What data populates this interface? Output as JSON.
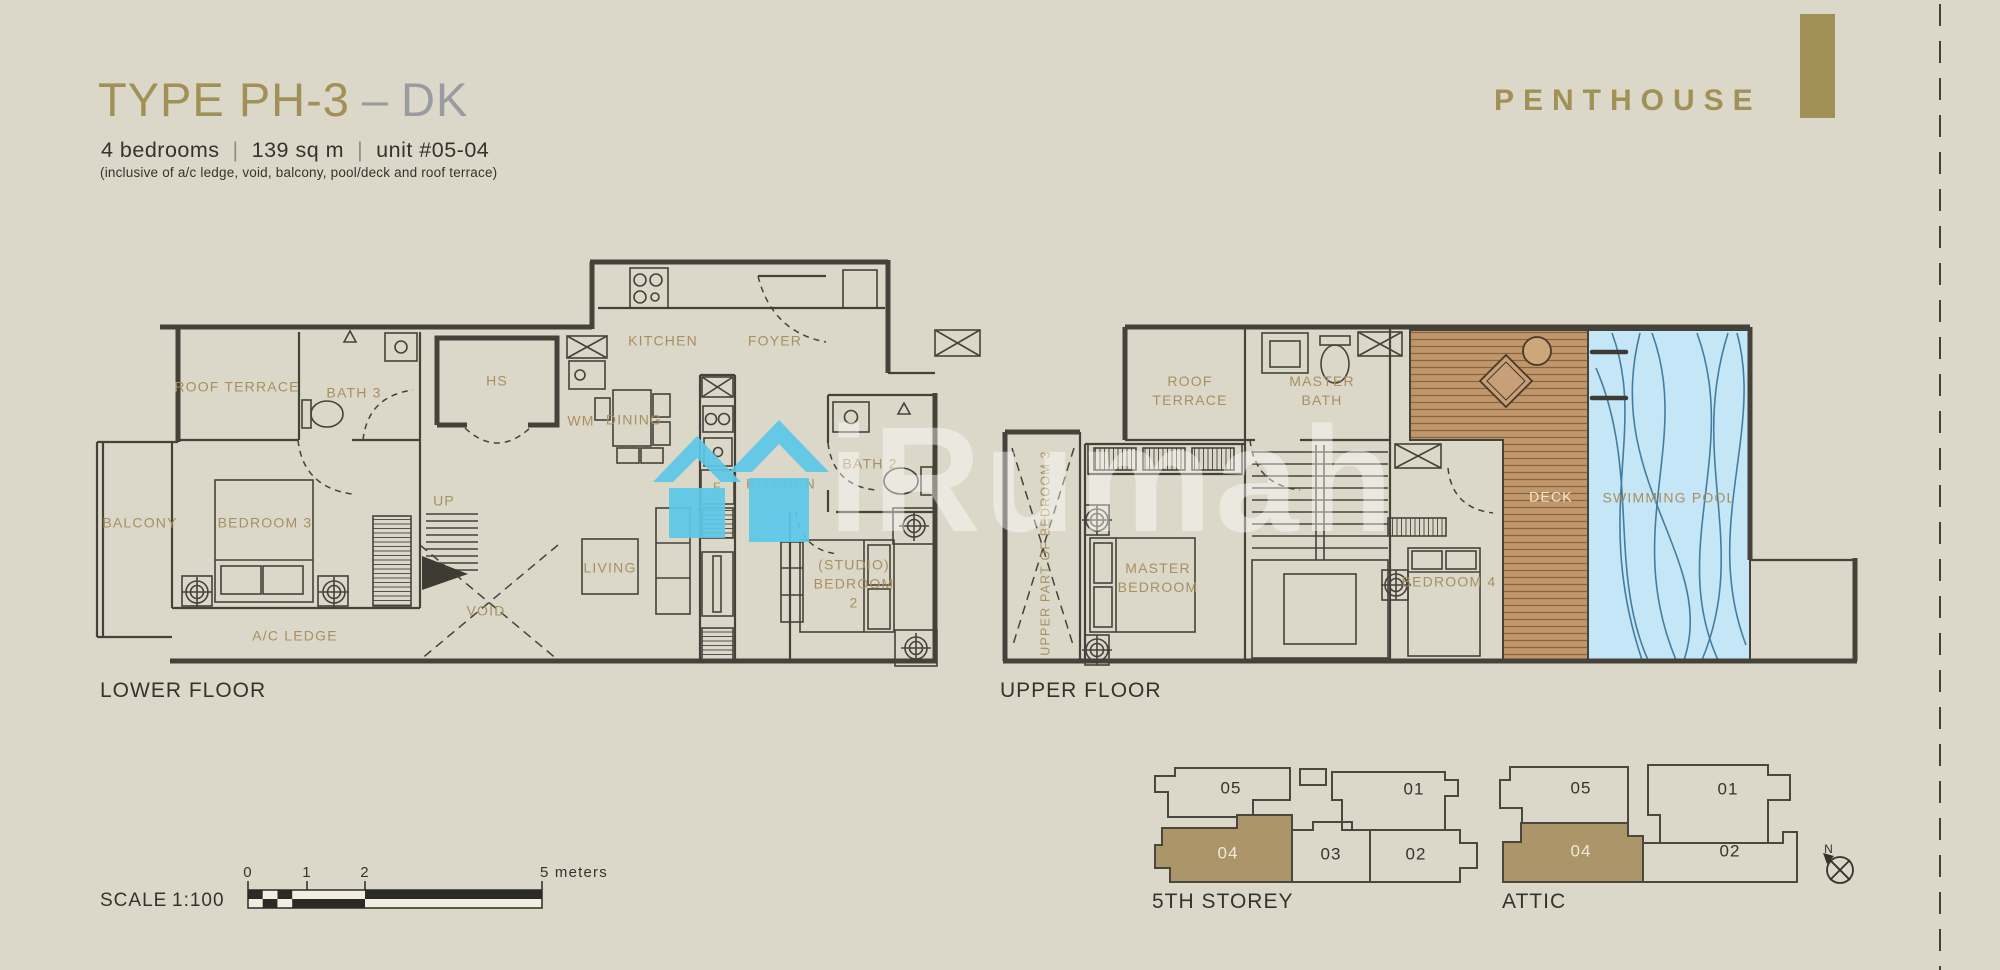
{
  "colors": {
    "background": "#dbd7c9",
    "accent_gold": "#a29156",
    "room_label_tan": "#a8905f",
    "wall_ink": "#45423a",
    "pool_blue_fill": "#c5e6f7",
    "pool_line_blue": "#2e6a92",
    "deck_brown": "#c0966a",
    "watermark_teal": "#5cc8e9",
    "highlight_unit_gold": "#ab9569"
  },
  "header": {
    "title_main": "TYPE PH-3",
    "title_sep": "–",
    "title_suffix": "DK",
    "bedrooms": "4 bedrooms",
    "area": "139 sq m",
    "unit": "unit #05-04",
    "separator": "|",
    "note": "(inclusive of a/c ledge, void, balcony, pool/deck and roof terrace)",
    "brand": "PENTHOUSE"
  },
  "watermark": {
    "brand": "iRumah"
  },
  "lower_floor": {
    "caption": "LOWER FLOOR",
    "labels": {
      "roof_terrace": "ROOF TERRACE",
      "bath3": "BATH 3",
      "hs": "HS",
      "kitchen": "KITCHEN",
      "foyer": "FOYER",
      "wm": "WM",
      "dining": "DINING",
      "kitchen2": "KITCHEN",
      "fridge": "F",
      "bath2": "BATH 2",
      "balcony": "BALCONY",
      "bedroom3": "BEDROOM 3",
      "up": "UP",
      "living": "LIVING",
      "void": "VOID",
      "studio_bedroom2": "(STUDIO) BEDROOM 2",
      "ac_ledge": "A/C LEDGE"
    }
  },
  "upper_floor": {
    "caption": "UPPER FLOOR",
    "labels": {
      "roof_terrace": "ROOF TERRACE",
      "master_bath": "MASTER BATH",
      "upper_part_bedroom3": "UPPER PART OF BEDROOM 3",
      "master_bedroom": "MASTER BEDROOM",
      "bedroom4": "BEDROOM 4",
      "deck": "DECK",
      "swimming_pool": "SWIMMING POOL"
    }
  },
  "scale_bar": {
    "label": "SCALE",
    "ratio": "1:100",
    "tick_0": "0",
    "tick_1": "1",
    "tick_2": "2",
    "tick_end": "5 meters"
  },
  "key_plans": {
    "fifth_storey": {
      "caption": "5TH STOREY",
      "unit_05": "05",
      "unit_01": "01",
      "unit_04": "04",
      "unit_03": "03",
      "unit_02": "02",
      "highlighted_unit": "04"
    },
    "attic": {
      "caption": "ATTIC",
      "unit_05": "05",
      "unit_01": "01",
      "unit_04": "04",
      "unit_02": "02",
      "highlighted_unit": "04"
    }
  },
  "compass": {
    "north": "N"
  }
}
